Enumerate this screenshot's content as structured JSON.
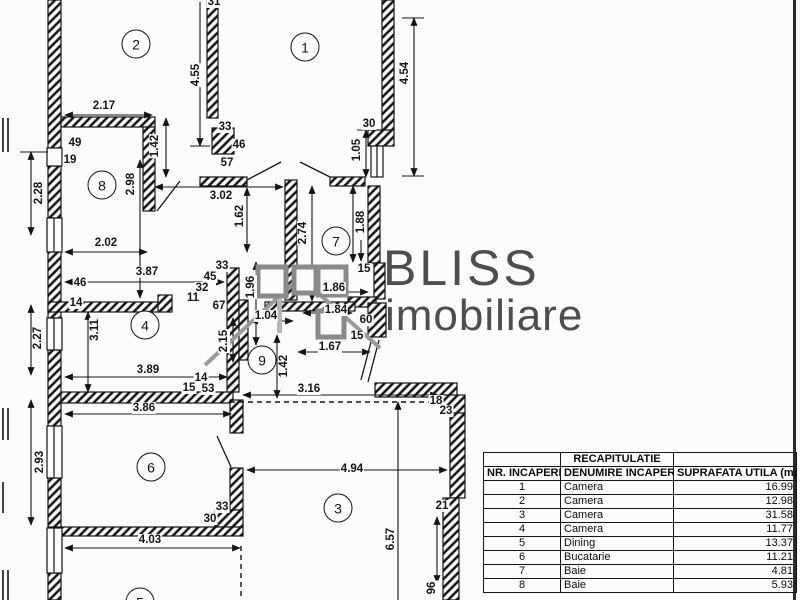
{
  "logo": {
    "brand": "BLISS",
    "brand2": "imobiliare"
  },
  "plan": {
    "rooms": [
      {
        "num": "2",
        "x": 136,
        "y": 44
      },
      {
        "num": "1",
        "x": 305,
        "y": 47
      },
      {
        "num": "8",
        "x": 102,
        "y": 185
      },
      {
        "num": "7",
        "x": 336,
        "y": 241
      },
      {
        "num": "4",
        "x": 145,
        "y": 325
      },
      {
        "num": "9",
        "x": 262,
        "y": 360
      },
      {
        "num": "6",
        "x": 151,
        "y": 467
      },
      {
        "num": "3",
        "x": 338,
        "y": 508
      },
      {
        "num": "5",
        "x": 140,
        "y": 602
      }
    ],
    "labels": [
      {
        "t": "31",
        "x": 214,
        "y": 2
      },
      {
        "t": "4.55",
        "x": 196,
        "y": 75,
        "r": 1
      },
      {
        "t": "4.54",
        "x": 405,
        "y": 73,
        "r": 1
      },
      {
        "t": "2.17",
        "x": 104,
        "y": 106
      },
      {
        "t": "49",
        "x": 75,
        "y": 143
      },
      {
        "t": "19",
        "x": 70,
        "y": 160
      },
      {
        "t": "1.42",
        "x": 155,
        "y": 146,
        "r": 1
      },
      {
        "t": "33",
        "x": 225,
        "y": 127
      },
      {
        "t": "46",
        "x": 239,
        "y": 145
      },
      {
        "t": "57",
        "x": 227,
        "y": 163
      },
      {
        "t": "2.98",
        "x": 131,
        "y": 184,
        "r": 1
      },
      {
        "t": "30",
        "x": 369,
        "y": 124
      },
      {
        "t": "1.05",
        "x": 357,
        "y": 150,
        "r": 1
      },
      {
        "t": "2.28",
        "x": 39,
        "y": 193,
        "r": 1
      },
      {
        "t": "3.02",
        "x": 221,
        "y": 196
      },
      {
        "t": "1.62",
        "x": 240,
        "y": 216,
        "r": 1
      },
      {
        "t": "1.88",
        "x": 361,
        "y": 222,
        "r": 1
      },
      {
        "t": "2.74",
        "x": 303,
        "y": 233,
        "r": 1
      },
      {
        "t": "15",
        "x": 364,
        "y": 269
      },
      {
        "t": "2.02",
        "x": 106,
        "y": 243
      },
      {
        "t": "3.87",
        "x": 147,
        "y": 272
      },
      {
        "t": "33",
        "x": 222,
        "y": 266
      },
      {
        "t": "45",
        "x": 210,
        "y": 277
      },
      {
        "t": "32",
        "x": 202,
        "y": 288
      },
      {
        "t": "11",
        "x": 193,
        "y": 298
      },
      {
        "t": "67",
        "x": 219,
        "y": 306
      },
      {
        "t": "46",
        "x": 80,
        "y": 283
      },
      {
        "t": "14",
        "x": 76,
        "y": 303
      },
      {
        "t": "1.96",
        "x": 251,
        "y": 287,
        "r": 1
      },
      {
        "t": "1.86",
        "x": 334,
        "y": 288
      },
      {
        "t": "1.84",
        "x": 336,
        "y": 310
      },
      {
        "t": "60",
        "x": 366,
        "y": 320
      },
      {
        "t": "15",
        "x": 357,
        "y": 336
      },
      {
        "t": "1.04",
        "x": 266,
        "y": 316
      },
      {
        "t": "3.11",
        "x": 95,
        "y": 330,
        "r": 1
      },
      {
        "t": "2.15",
        "x": 224,
        "y": 341,
        "r": 1
      },
      {
        "t": "1.67",
        "x": 330,
        "y": 347
      },
      {
        "t": "1.42",
        "x": 284,
        "y": 366,
        "r": 1
      },
      {
        "t": "2.27",
        "x": 38,
        "y": 338,
        "r": 1
      },
      {
        "t": "3.89",
        "x": 148,
        "y": 370
      },
      {
        "t": "14",
        "x": 201,
        "y": 378
      },
      {
        "t": "15",
        "x": 189,
        "y": 388
      },
      {
        "t": "53",
        "x": 208,
        "y": 389
      },
      {
        "t": "3.16",
        "x": 309,
        "y": 389
      },
      {
        "t": "18",
        "x": 436,
        "y": 401
      },
      {
        "t": "23",
        "x": 446,
        "y": 411
      },
      {
        "t": "3.86",
        "x": 144,
        "y": 408
      },
      {
        "t": "2.93",
        "x": 40,
        "y": 462,
        "r": 1
      },
      {
        "t": "33",
        "x": 222,
        "y": 507
      },
      {
        "t": "30",
        "x": 210,
        "y": 519
      },
      {
        "t": "4.03",
        "x": 150,
        "y": 540
      },
      {
        "t": "4.94",
        "x": 352,
        "y": 469
      },
      {
        "t": "21",
        "x": 442,
        "y": 506
      },
      {
        "t": "6.57",
        "x": 391,
        "y": 539,
        "r": 1
      },
      {
        "t": "96",
        "x": 432,
        "y": 588,
        "r": 1
      }
    ]
  },
  "table": {
    "title": "RECAPITULATIE",
    "headers": [
      "NR. INCAPERE",
      "DENUMIRE INCAPERE",
      "SUPRAFATA UTILA (mp)"
    ],
    "rows": [
      {
        "nr": "1",
        "name": "Camera",
        "area": "16.99"
      },
      {
        "nr": "2",
        "name": "Camera",
        "area": "12.98"
      },
      {
        "nr": "3",
        "name": "Camera",
        "area": "31.58"
      },
      {
        "nr": "4",
        "name": "Camera",
        "area": "11.77"
      },
      {
        "nr": "5",
        "name": "Dining",
        "area": "13.37"
      },
      {
        "nr": "6",
        "name": "Bucatarie",
        "area": "11.21"
      },
      {
        "nr": "7",
        "name": "Baie",
        "area": "4.81"
      },
      {
        "nr": "8",
        "name": "Baie",
        "area": "5.93"
      }
    ]
  }
}
